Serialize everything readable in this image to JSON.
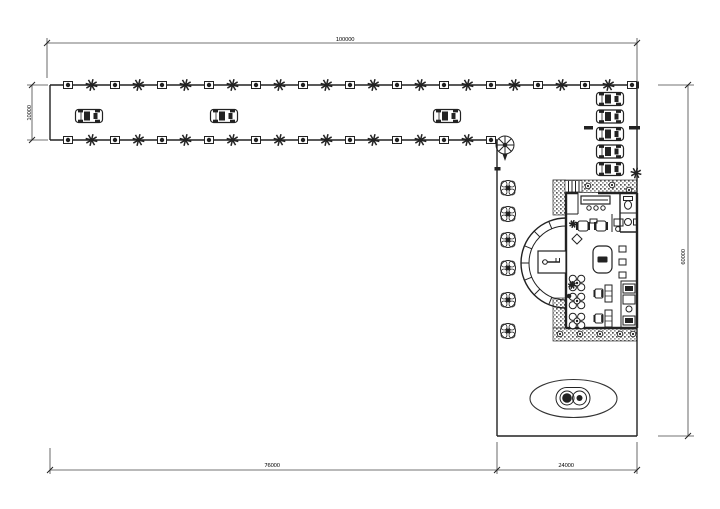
{
  "drawing": {
    "type": "architectural-site-plan",
    "dimensions": {
      "top_width": "100000",
      "strip_height": "10000",
      "right_height": "60000",
      "bottom_left_width": "76000",
      "bottom_right_width": "24000"
    },
    "colors": {
      "ink": "#222222",
      "dim_line": "#444444",
      "paper": "#ffffff"
    },
    "planting_rows": [
      {
        "name": "north-row",
        "y": 85,
        "x_start": 68,
        "step": 23.5,
        "count": 25
      },
      {
        "name": "south-row",
        "y": 140,
        "x_start": 68,
        "step": 23.5,
        "count": 19
      }
    ],
    "drive_cars": [
      {
        "x": 89,
        "y": 116
      },
      {
        "x": 224,
        "y": 116
      },
      {
        "x": 447,
        "y": 116
      }
    ],
    "parked_cars": [
      {
        "x": 610,
        "y": 99
      },
      {
        "x": 610,
        "y": 116.5
      },
      {
        "x": 610,
        "y": 134
      },
      {
        "x": 610,
        "y": 151.5
      },
      {
        "x": 610,
        "y": 169
      }
    ],
    "wing_trees": [
      {
        "x": 508,
        "y": 188
      },
      {
        "x": 508,
        "y": 214
      },
      {
        "x": 508,
        "y": 240
      },
      {
        "x": 508,
        "y": 268
      },
      {
        "x": 508,
        "y": 300
      },
      {
        "x": 508,
        "y": 331
      }
    ],
    "dining_tables": [
      {
        "x": 577,
        "y": 283
      },
      {
        "x": 577,
        "y": 301
      },
      {
        "x": 577,
        "y": 321
      }
    ],
    "desk_sets": [
      {
        "x": 603,
        "y": 293
      },
      {
        "x": 603,
        "y": 318
      }
    ],
    "paver_plants": [
      {
        "x": 560,
        "y": 334
      },
      {
        "x": 580,
        "y": 334
      },
      {
        "x": 600,
        "y": 334
      },
      {
        "x": 620,
        "y": 334
      },
      {
        "x": 633,
        "y": 334
      },
      {
        "x": 588,
        "y": 186
      },
      {
        "x": 612,
        "y": 185
      },
      {
        "x": 629,
        "y": 190
      }
    ]
  }
}
